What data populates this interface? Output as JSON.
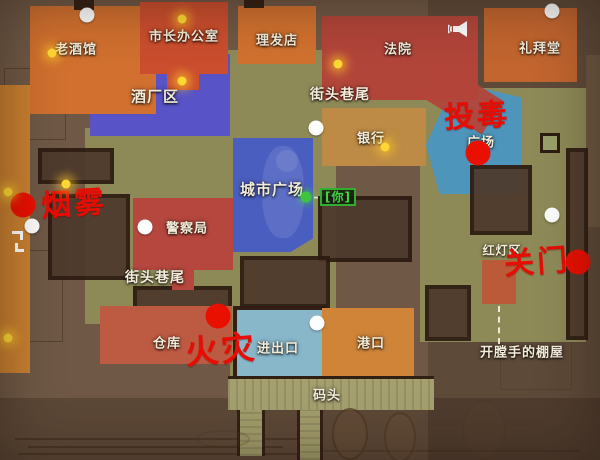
{
  "map": {
    "locations": {
      "old_tavern": "老酒馆",
      "mayors_office": "市长办公室",
      "barbershop": "理发店",
      "courthouse": "法院",
      "chapel": "礼拜堂",
      "brewery_district": "酒厂区",
      "street_corner_upper": "街头巷尾",
      "bank": "银行",
      "plaza": "广场",
      "city_plaza": "城市广场",
      "police_station": "警察局",
      "street_corner_lower": "街头巷尾",
      "red_light_district": "红灯区",
      "warehouse": "仓库",
      "entry_exit": "进出口",
      "port": "港口",
      "dock": "码头",
      "rippers_shack": "开膛手的棚屋"
    },
    "events": {
      "smoke": "烟雾",
      "poison": "投毒",
      "gate_closed": "关门",
      "fire": "火灾"
    },
    "player_marker": {
      "dash": "-",
      "tag": "[你]"
    },
    "icons": {
      "megaphone": "megaphone-icon"
    },
    "markers": {
      "red_count": 4,
      "white_count": 7,
      "yellow_count": 8,
      "green_count": 1
    },
    "colors": {
      "event_red": "#e60d04",
      "marker_red": "#ea1000",
      "marker_white": "#fdfdfd",
      "marker_yellow": "#ffd733",
      "player_green": "#3ec43e",
      "building_red": "#b2453a",
      "building_orange": "#d1702f",
      "warehouse_red": "#bd5a42",
      "bank_tan": "#bd8b45",
      "brewery_blue": "#5853c6",
      "city_plaza_blue": "#4a5ec0",
      "plaza_blue": "#4596c8",
      "entry_blue": "#88b7ca",
      "street_olive": "#8e8a58",
      "dock_tan": "#a5a06f",
      "wall_dark": "#332015",
      "background_brown": "#6f5946"
    }
  }
}
